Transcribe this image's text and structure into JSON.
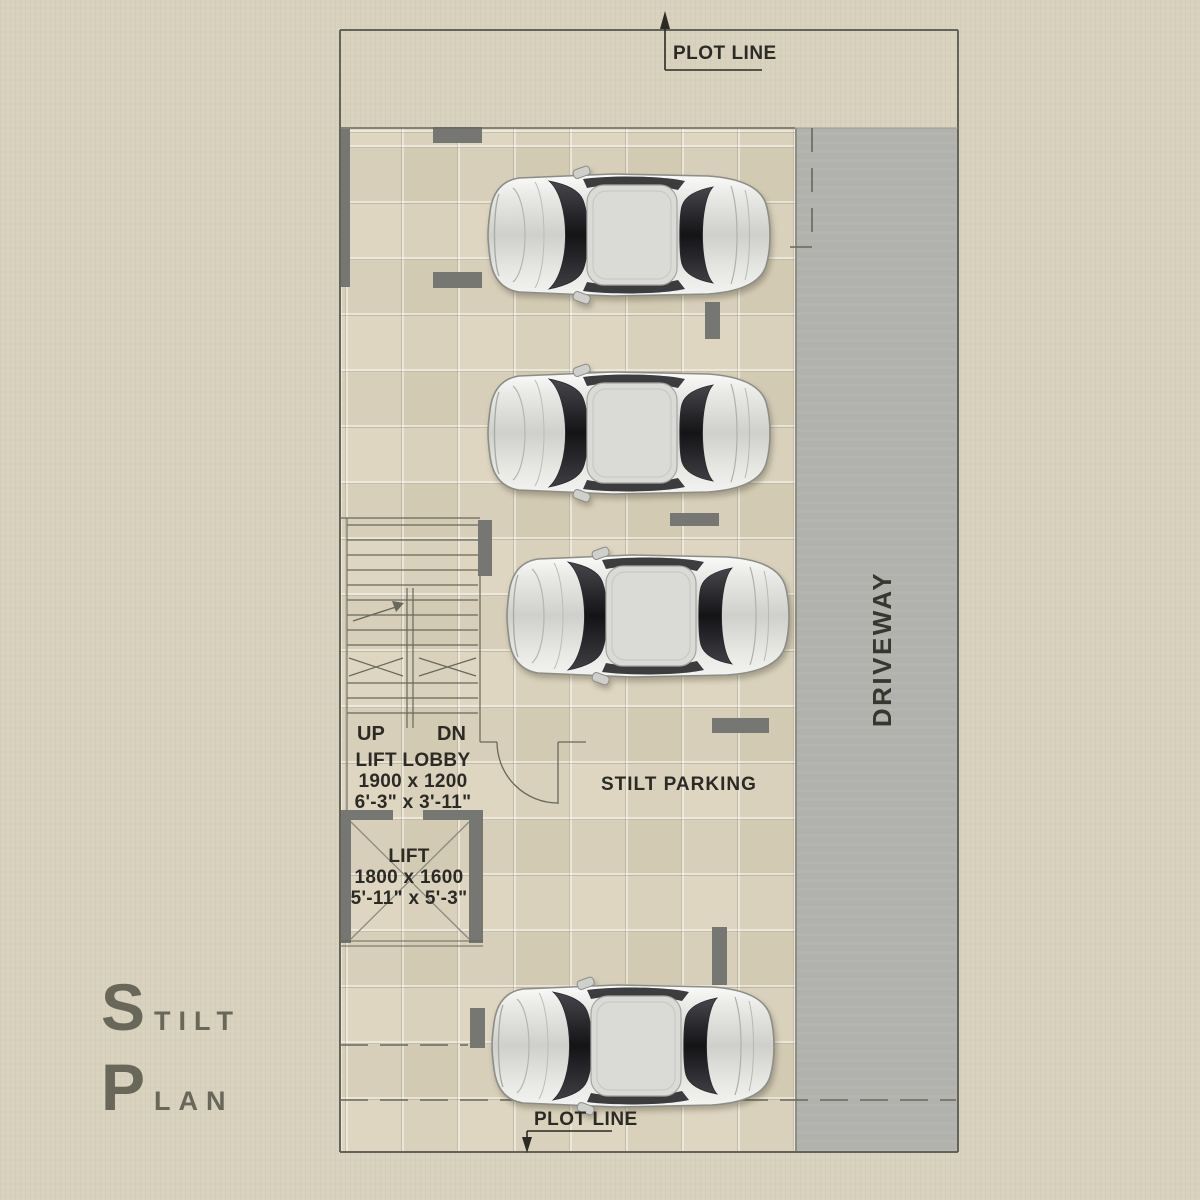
{
  "title": {
    "line1": "STILT",
    "line2": "PLAN"
  },
  "labels": {
    "plot_line_top": "PLOT LINE",
    "plot_line_bottom": "PLOT LINE",
    "driveway": "DRIVEWAY",
    "stilt_parking": "STILT PARKING",
    "up": "UP",
    "dn": "DN",
    "lift_lobby": {
      "name": "LIFT LOBBY",
      "dim_mm": "1900 x 1200",
      "dim_ft": "6'-3\" x 3'-11\""
    },
    "lift": {
      "name": "LIFT",
      "dim_mm": "1800 x 1600",
      "dim_ft": "5'-11\" x 5'-3\""
    }
  },
  "cars": {
    "count": 4,
    "style": "silver sedan, top view, parked horizontally"
  },
  "colors": {
    "canvas": "#d8d1bd",
    "tile_floor": "#ded6c1",
    "driveway": "#b1b2ae",
    "column": "#767672",
    "plan_line": "#68685c",
    "text": "#2b2a25",
    "title": "#696759"
  }
}
